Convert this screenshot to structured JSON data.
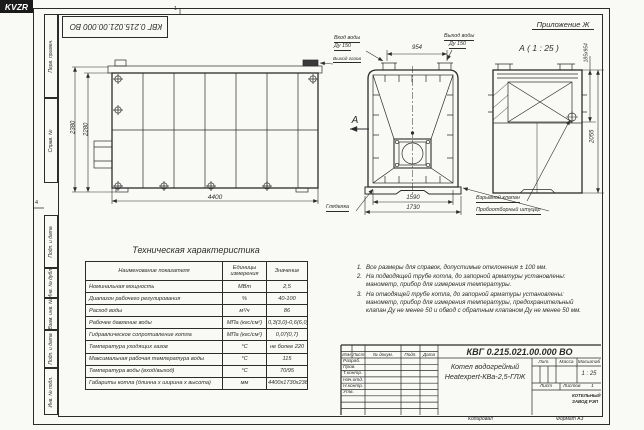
{
  "sheet": {
    "doc_number_top": "КВГ 0.215.021.00.000 ВО",
    "zone_marker_top": "1",
    "zone_marker_left": "4",
    "left_strip": {
      "cells": [
        {
          "label": "Перв. примен."
        },
        {
          "label": "Справ. №"
        },
        {
          "label": "Подп. и дата"
        },
        {
          "label": "Инв. № дубл."
        },
        {
          "label": "Взам. инв. №"
        },
        {
          "label": "Подп. и дата"
        },
        {
          "label": "Инв. № подл."
        }
      ]
    }
  },
  "side_view": {
    "dim_outer_height": "2380",
    "dim_inner_height": "2280",
    "dim_length": "4400"
  },
  "front_view": {
    "water_inlet_label": "Вход воды",
    "water_inlet_dn": "Ду 150",
    "water_outlet_label": "Выход воды",
    "water_outlet_dn": "Ду 150",
    "gas_outlet_label": "Выход газов",
    "dim_nozzle_spacing": "954",
    "dim_inner_width": "1590",
    "dim_outer_width": "1730",
    "sight_glass_label": "Гляделка",
    "section_mark": "А"
  },
  "section_view": {
    "annex_label": "Приложение Ж",
    "view_title": "А ( 1 : 25 )",
    "dim_flue": "185х954",
    "dim_height": "2055",
    "explosion_valve_label": "Взрывной клапан",
    "sampling_fitting_label": "Пробоотборный штуцер"
  },
  "spec_table": {
    "title": "Техническая характеристика",
    "headers": {
      "name": "Наименование показателя",
      "units": "Единицы измерения",
      "value": "Значение"
    },
    "rows": [
      {
        "name": "Номинальная мощность",
        "units": "МВт",
        "value": "2,5"
      },
      {
        "name": "Диапазон рабочего регулирования",
        "units": "%",
        "value": "40-100"
      },
      {
        "name": "Расход воды",
        "units": "м³/ч",
        "value": "86"
      },
      {
        "name": "Рабочее давление воды",
        "units": "МПа (кгс/см²)",
        "value": "0,3(3,0)-0,6(6,0)"
      },
      {
        "name": "Гидравлическое сопротивление котла",
        "units": "МПа (кгс/см²)",
        "value": "0,07(0,7)"
      },
      {
        "name": "Температура уходящих газов",
        "units": "°С",
        "value": "не более 220"
      },
      {
        "name": "Максимальная рабочая температура воды",
        "units": "°С",
        "value": "115"
      },
      {
        "name": "Температура воды (вход/выход)",
        "units": "°С",
        "value": "70/95"
      },
      {
        "name": "Габариты котла (длинна х ширина х высота)",
        "units": "мм",
        "value": "4400х1730х2380"
      }
    ]
  },
  "notes": [
    {
      "num": "1.",
      "text": "Все размеры для справок, допустимые отклонения ± 100 мм."
    },
    {
      "num": "2.",
      "text": "На подводящей трубе котла, до запорной арматуры установлены: манометр, прибор для измерения температуры."
    },
    {
      "num": "3.",
      "text": "На отводящей трубе котла, до запорной арматуры установлены: манометр, прибор для измерения температуры, предохранительный клапан Ду не менее 50 и обвод с обратным клапаном Ду не менее 50 мм."
    }
  ],
  "title_block": {
    "doc_number": "КВГ 0.215.021.00.000 ВО",
    "product_name_1": "Котел водогрейный",
    "product_name_2": "Heatexpert-КВа-2,5-ГЛЖ",
    "header_cols": [
      "Изм",
      "Лист",
      "№ докум.",
      "Подп.",
      "Дата"
    ],
    "role_rows": [
      "Разраб.",
      "Пров.",
      "Т.контр.",
      "Нач.отд.",
      "Н.контр.",
      "Утв."
    ],
    "lit_label": "Лит.",
    "mass_label": "Масса",
    "scale_label": "Масштаб",
    "scale_value": "1 : 25",
    "sheet_label": "Лист",
    "sheets_label": "Листов",
    "sheets_value": "1",
    "logo_text": "KVZR",
    "logo_caption_1": "КОТЕЛЬНЫЙ",
    "logo_caption_2": "ЗАВОД РЭП",
    "copied_label": "Копировал",
    "format_label": "Формат А3"
  }
}
